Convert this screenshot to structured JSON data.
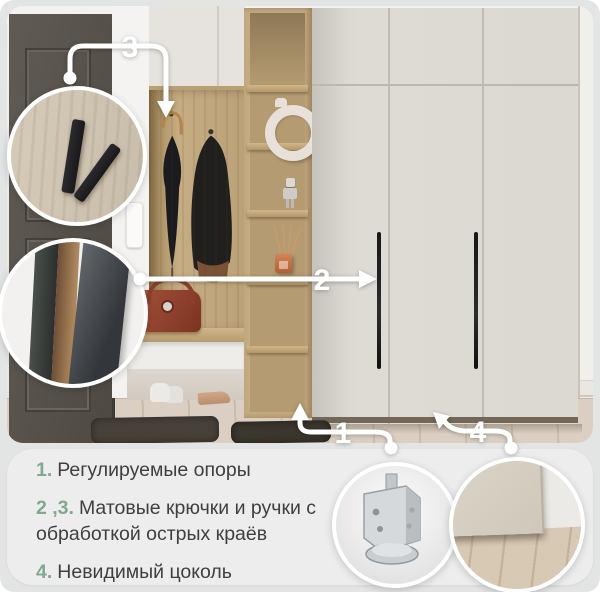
{
  "callouts": {
    "n1": "1",
    "n2": "2",
    "n3": "3",
    "n4": "4"
  },
  "legend": {
    "items": [
      {
        "num": "1.",
        "text": "Регулируемые опоры"
      },
      {
        "num": "2 ,3.",
        "text": "Матовые крючки и ручки с обработкой острых краёв"
      },
      {
        "num": "4.",
        "text": "Невидимый цоколь"
      }
    ]
  },
  "colors": {
    "page_bg": "#e3e4e4",
    "panel_bg": "#ededee",
    "accent_green": "#82a88e",
    "text": "#3f3f41",
    "callout_white": "#ffffff",
    "wardrobe_beige": "#dcd8d2",
    "oak_wood": "#c4aa80",
    "door_dark": "#56514a",
    "handle_black": "#1e1e20"
  }
}
